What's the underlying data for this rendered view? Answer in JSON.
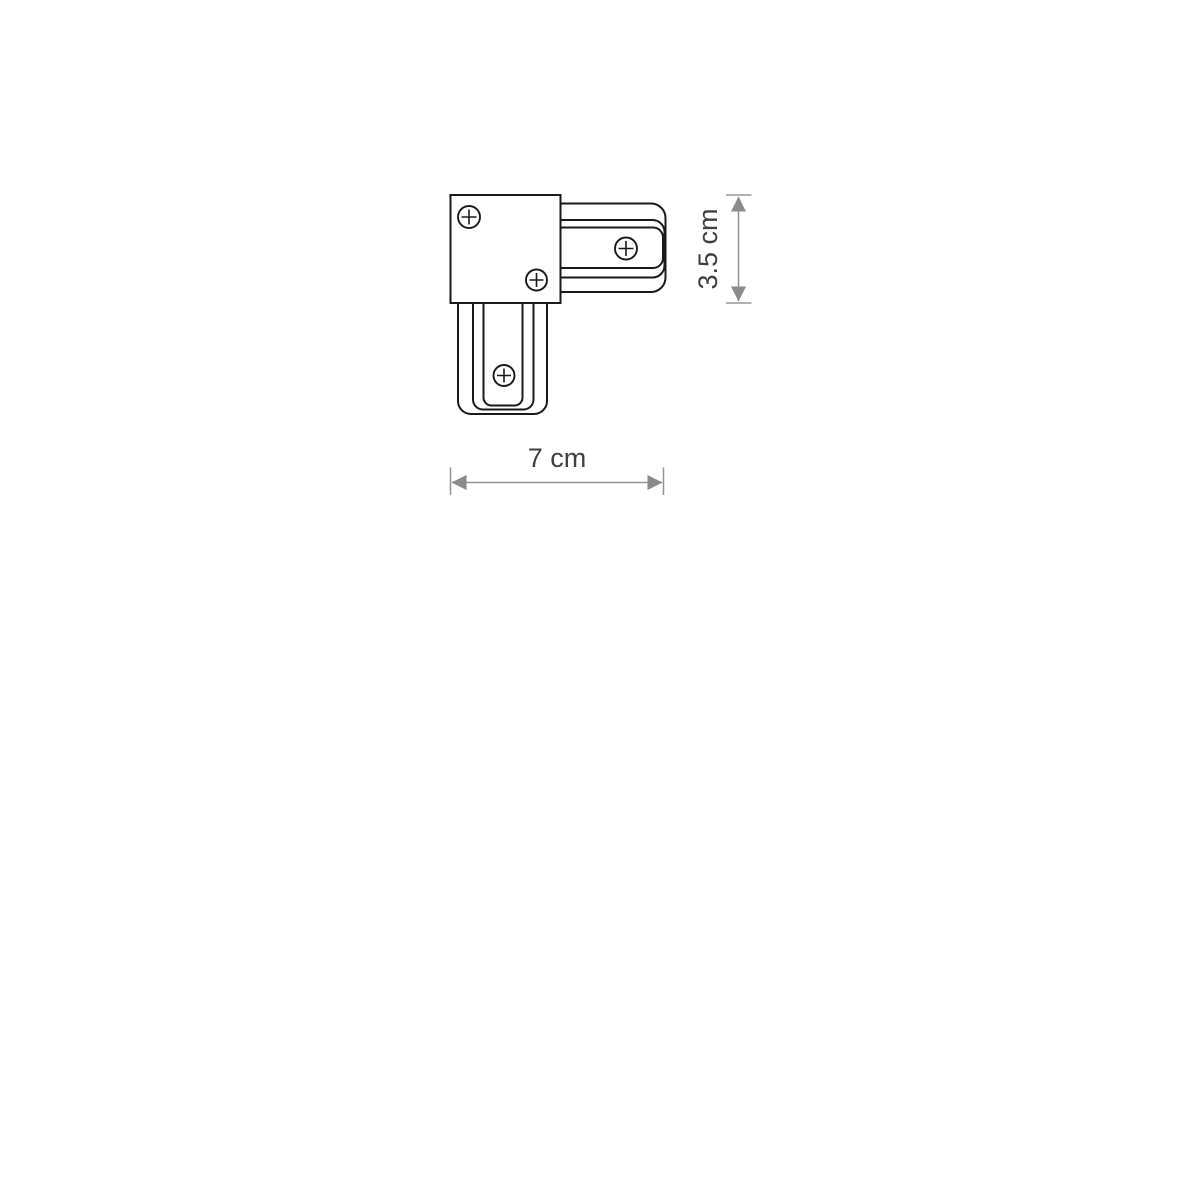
{
  "diagram": {
    "type": "technical-line-drawing",
    "subject": "L-shaped track corner connector, top view",
    "labels": {
      "width": "7 cm",
      "height": "3.5 cm"
    },
    "screws_count": 4,
    "icons": {
      "screw": "screw-head-icon"
    },
    "colors": {
      "outline": "#1a1a1a",
      "dimension_line": "#959595",
      "dimension_arrow": "#8a8a8a",
      "dimension_text": "#3f3f3f",
      "background": "#ffffff"
    }
  }
}
